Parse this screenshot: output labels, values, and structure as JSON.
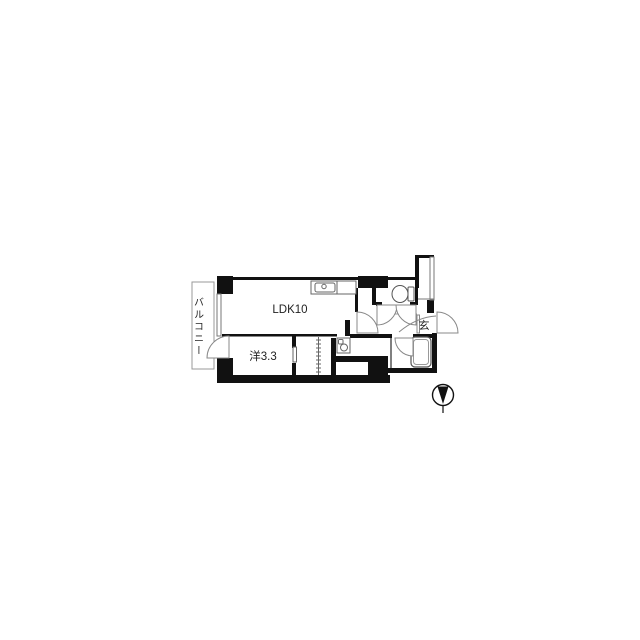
{
  "floor_plan": {
    "labels": {
      "balcony": "バルコニー",
      "ldk": "LDK10",
      "western_room": "洋3.3",
      "entrance": "玄"
    },
    "colors": {
      "wall": "#111111",
      "thin_line": "#777777",
      "fixture_line": "#666666",
      "background": "#ffffff"
    },
    "compass": {
      "direction": "up"
    }
  }
}
